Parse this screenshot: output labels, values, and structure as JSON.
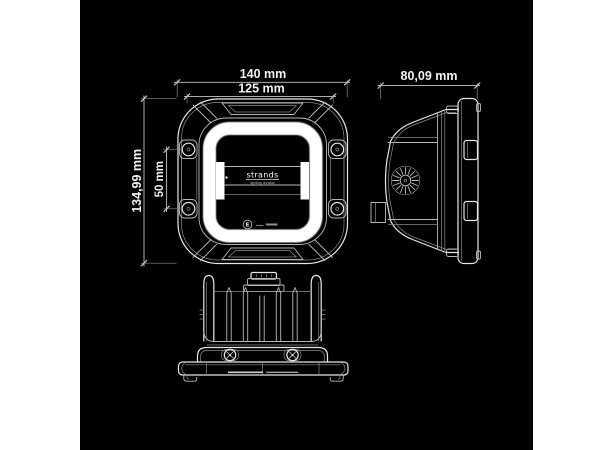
{
  "page": {
    "colors": {
      "page_bg": "#ffffff",
      "canvas_bg": "#000000",
      "line_bright": "#e6e6e6",
      "line_mid": "#b8b8b8",
      "line_dim": "#8a8a8a",
      "dim_color": "#c4c4c4",
      "text": "#f2f2f2",
      "glow": "#ffffff"
    }
  },
  "dimensions": {
    "front_width_outer": {
      "label": "140 mm"
    },
    "front_width_lens": {
      "label": "125 mm"
    },
    "front_height": {
      "label": "134,99 mm"
    },
    "mounting_hole_spacing": {
      "label": "50 mm"
    },
    "side_depth": {
      "label": "80,09 mm"
    }
  },
  "branding": {
    "logo_text": "strands",
    "logo_subtext": "lighting division"
  },
  "approval": {
    "emark_letter": "E"
  }
}
